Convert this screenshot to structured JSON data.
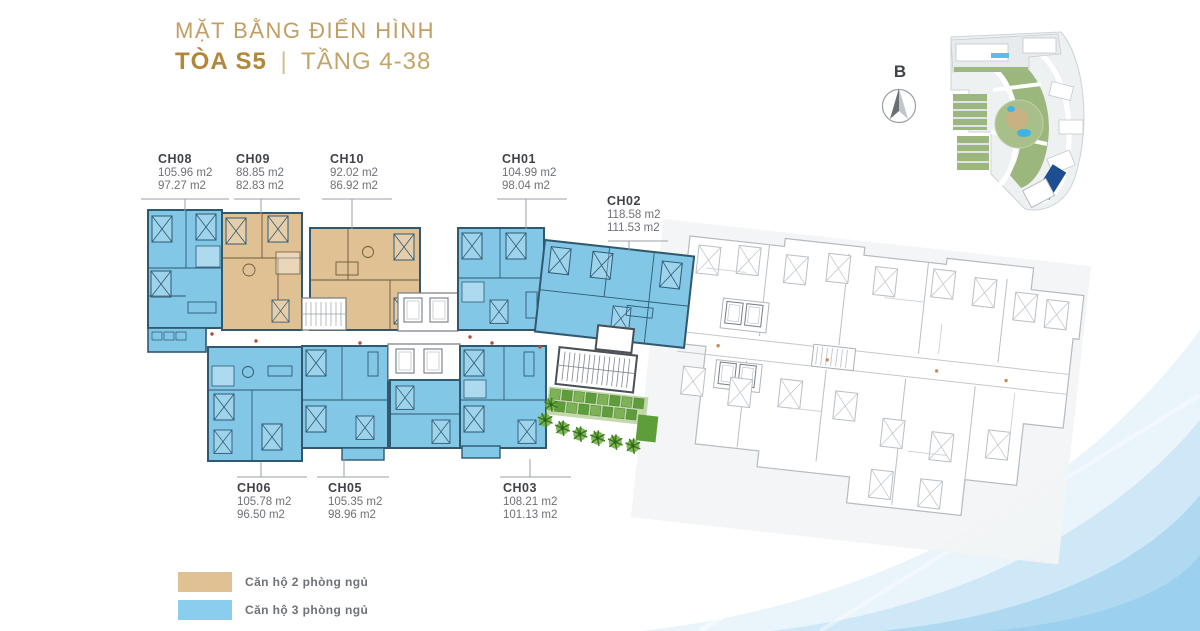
{
  "title": {
    "heading": "MẶT BẰNG ĐIỂN HÌNH",
    "tower": "TÒA S5",
    "separator": "|",
    "floors": "TẦNG 4-38"
  },
  "compass": {
    "north_label": "B"
  },
  "units": [
    {
      "id": "CH08",
      "area1": "105.96 m2",
      "area2": "97.27 m2"
    },
    {
      "id": "CH09",
      "area1": "88.85 m2",
      "area2": "82.83 m2"
    },
    {
      "id": "CH10",
      "area1": "92.02 m2",
      "area2": "86.92 m2"
    },
    {
      "id": "CH01",
      "area1": "104.99 m2",
      "area2": "98.04 m2"
    },
    {
      "id": "CH02",
      "area1": "118.58 m2",
      "area2": "111.53 m2"
    },
    {
      "id": "CH06",
      "area1": "105.78 m2",
      "area2": "96.50 m2"
    },
    {
      "id": "CH05",
      "area1": "105.35 m2",
      "area2": "98.96 m2"
    },
    {
      "id": "CH03",
      "area1": "108.21 m2",
      "area2": "101.13 m2"
    }
  ],
  "legend": {
    "items": [
      {
        "label": "Căn hộ 2 phòng ngủ",
        "color": "#e0c194"
      },
      {
        "label": "Căn hộ 3 phòng ngủ",
        "color": "#8bcdec"
      }
    ]
  },
  "colors": {
    "title_gold": "#c19e63",
    "tower_gold": "#b2873c",
    "unit_2br_fill": "#e0c194",
    "unit_3br_fill": "#82c7e6",
    "unit_wall": "#30586f",
    "inactive_plan_line": "#b5bbc0",
    "site_map_highlight": "#1c4e91",
    "swoosh_blue": "#a8d5ef",
    "landscape_green": "#57962f"
  }
}
